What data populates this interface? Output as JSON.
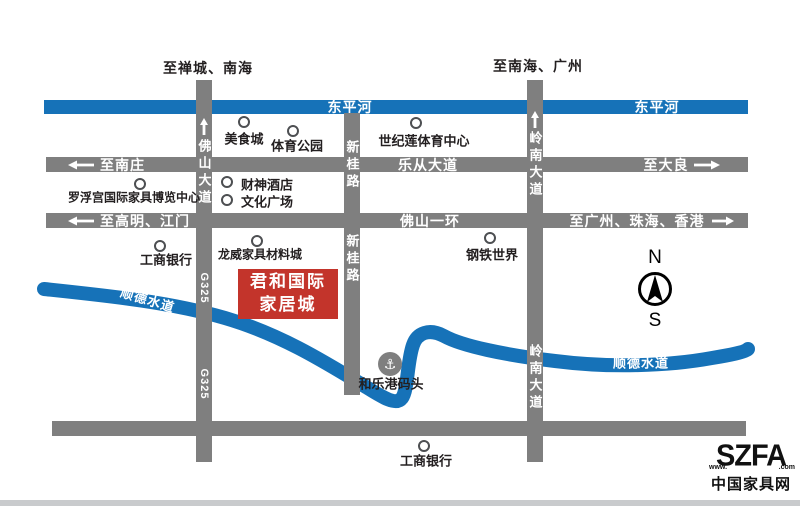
{
  "colors": {
    "river": "#1672B8",
    "road": "#7F7F7F",
    "landmark_red": "#C3342B",
    "text": "#231F20"
  },
  "top_destinations": {
    "left": "至禅城、南海",
    "right": "至南海、广州"
  },
  "dongping_river": {
    "label_a": "东平河",
    "label_b": "东平河"
  },
  "shunde_river": {
    "label_left": "顺德水道",
    "label_right": "顺德水道"
  },
  "roads": {
    "lecong": {
      "west_dest": "至南庄",
      "name": "乐从大道",
      "east_dest": "至大良"
    },
    "yihuan": {
      "west_dest": "至高明、江门",
      "name": "佛山一环",
      "east_dest": "至广州、珠海、香港"
    },
    "foshan_avenue": {
      "name": "佛山大道",
      "g325_a": "G325",
      "g325_b": "G325"
    },
    "xingui": {
      "name_upper": "新桂路",
      "name_lower": "新桂路"
    },
    "lingnan": {
      "name_upper": "岭南大道",
      "name_lower": "岭南大道"
    }
  },
  "pois": [
    {
      "label": "美食城",
      "cx": 244,
      "cy": 122,
      "tx": 244,
      "ty": 138,
      "align": "center"
    },
    {
      "label": "体育公园",
      "cx": 293,
      "cy": 131,
      "tx": 297,
      "ty": 145,
      "align": "center"
    },
    {
      "label": "世纪莲体育中心",
      "cx": 416,
      "cy": 123,
      "tx": 424,
      "ty": 140,
      "align": "center"
    },
    {
      "label": "财神酒店",
      "cx": 227,
      "cy": 182,
      "tx": 241,
      "ty": 184,
      "align": "left"
    },
    {
      "label": "文化广场",
      "cx": 227,
      "cy": 200,
      "tx": 241,
      "ty": 201,
      "align": "left"
    },
    {
      "label": "罗浮宫国际家具博览中心",
      "cx": 140,
      "cy": 184,
      "tx": 134,
      "ty": 197,
      "align": "center",
      "small": true
    },
    {
      "label": "工商银行",
      "cx": 160,
      "cy": 246,
      "tx": 166,
      "ty": 259,
      "align": "center"
    },
    {
      "label": "龙威家具材料城",
      "cx": 257,
      "cy": 241,
      "tx": 260,
      "ty": 254,
      "align": "center",
      "small": true
    },
    {
      "label": "钢铁世界",
      "cx": 490,
      "cy": 238,
      "tx": 492,
      "ty": 254,
      "align": "center"
    },
    {
      "label": "工商银行",
      "cx": 424,
      "cy": 446,
      "tx": 426,
      "ty": 460,
      "align": "center"
    }
  ],
  "landmark": {
    "line1": "君和国际",
    "line2": "家居城"
  },
  "port": {
    "label": "和乐港码头"
  },
  "compass": {
    "north": "N",
    "south": "S"
  },
  "logo": {
    "www": "www.",
    "brand": "SZFA",
    "com": ".com",
    "site_name": "中国家具网"
  }
}
